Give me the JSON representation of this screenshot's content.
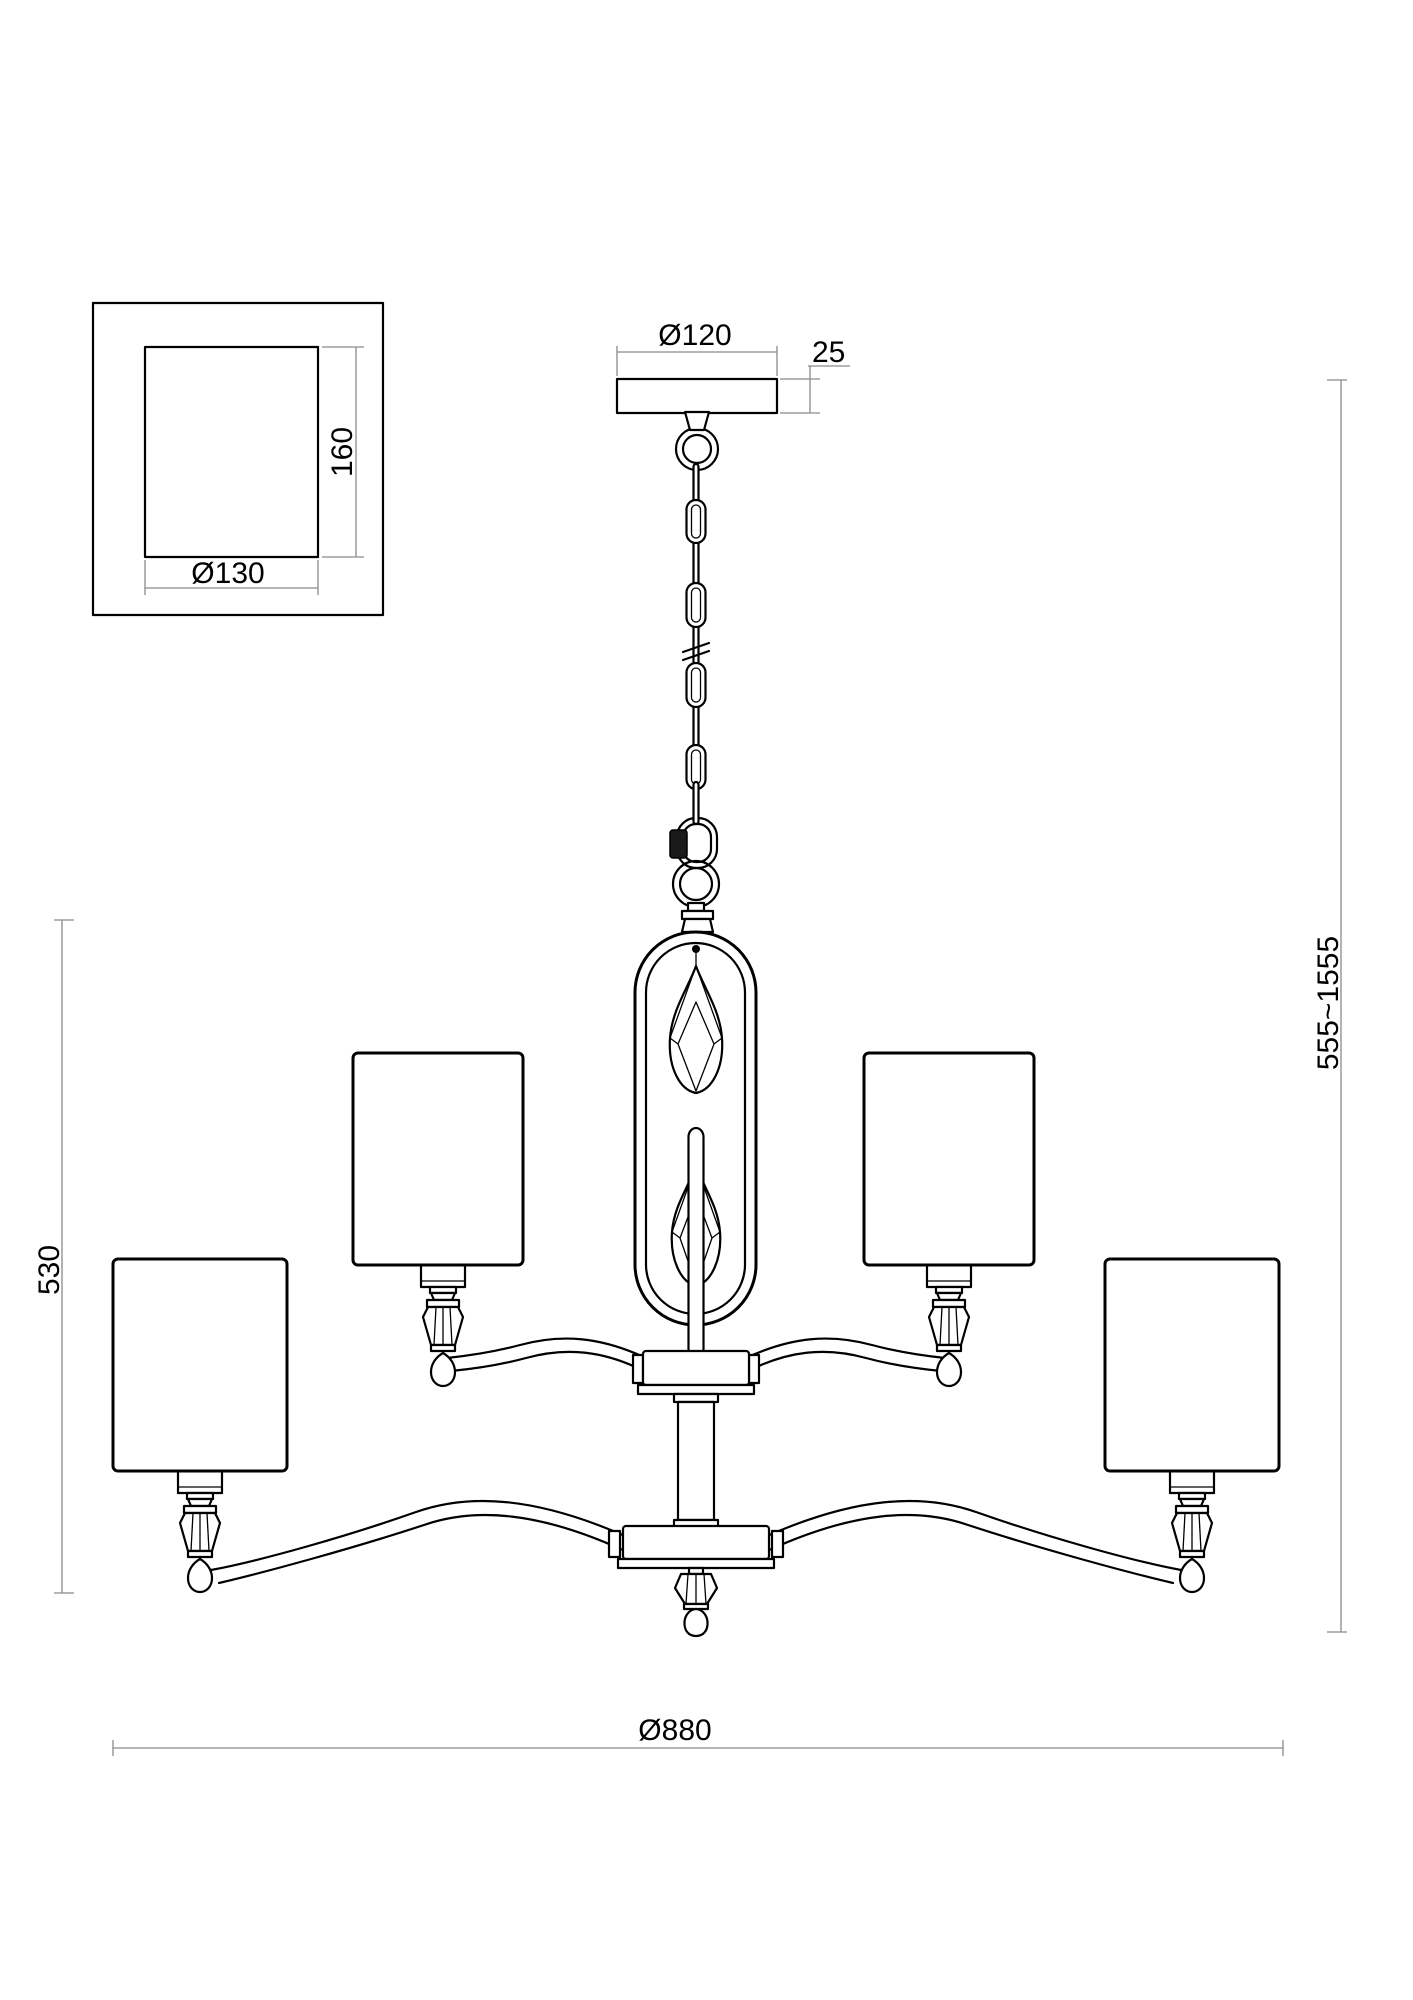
{
  "drawing": {
    "background": "#ffffff",
    "line_color": "#000000",
    "dim_line_color": "#8a8a8a",
    "labels": {
      "mount_width": "Ø130",
      "mount_height": "160",
      "canopy_diameter": "Ø120",
      "canopy_thickness": "25",
      "body_height": "530",
      "suspension_height": "555~1555",
      "overall_diameter": "Ø880"
    }
  }
}
